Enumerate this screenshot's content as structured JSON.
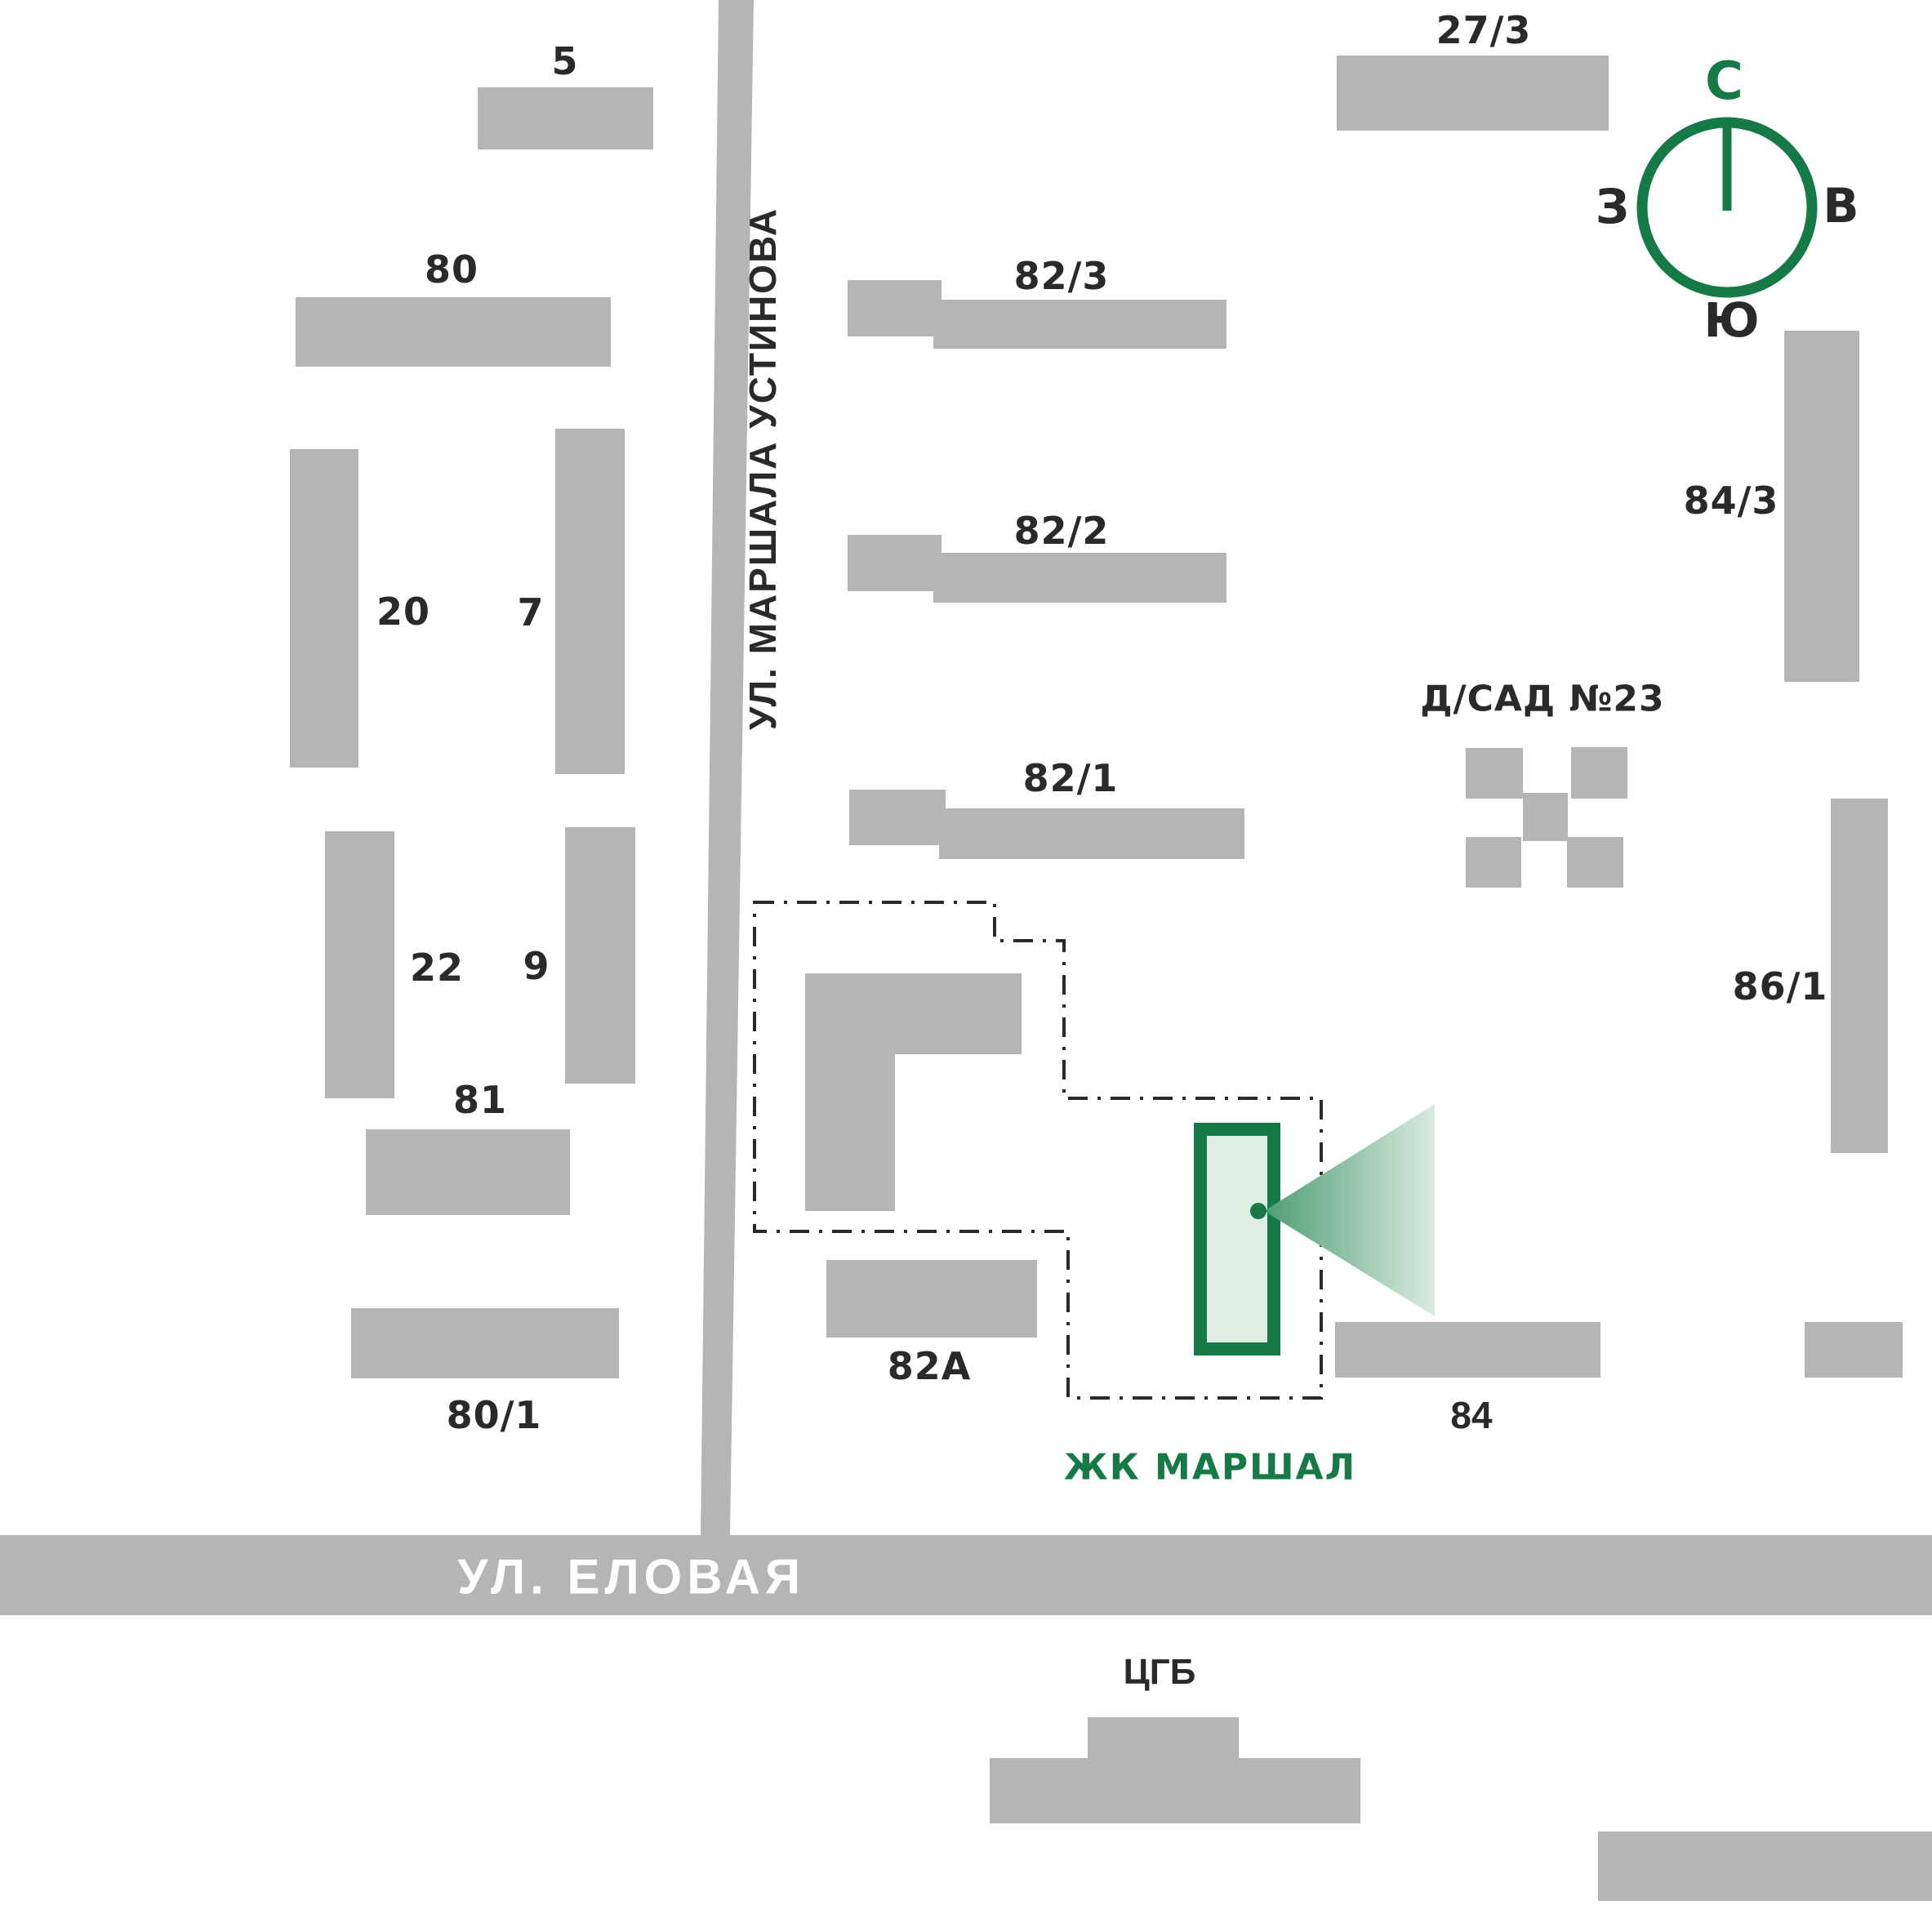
{
  "labels": {
    "b5": "5",
    "b80": "80",
    "b20": "20",
    "b7": "7",
    "b22": "22",
    "b9": "9",
    "b81": "81",
    "b80_1": "80/1",
    "b82_3": "82/3",
    "b82_2": "82/2",
    "b82_1": "82/1",
    "b27_3": "27/3",
    "b84_3": "84/3",
    "b86_1": "86/1",
    "b82a": "82А",
    "b84": "84",
    "kindergarten": "Д/САД №23",
    "hospital": "ЦГБ",
    "complex": "ЖК МАРШАЛ"
  },
  "streets": {
    "vertical": "УЛ. МАРШАЛА УСТИНОВА",
    "horizontal": "УЛ. ЕЛОВАЯ"
  },
  "compass": {
    "north": "С",
    "east": "В",
    "south": "Ю",
    "west": "З"
  },
  "colors": {
    "building_gray": "#b5b5b5",
    "road_gray": "#b5b5b5",
    "text_dark": "#2b2a29",
    "accent_green": "#157a46",
    "complex_fill": "#dfeee3",
    "cone_start": "#4f9d74",
    "cone_end": "#d9ebe0"
  }
}
